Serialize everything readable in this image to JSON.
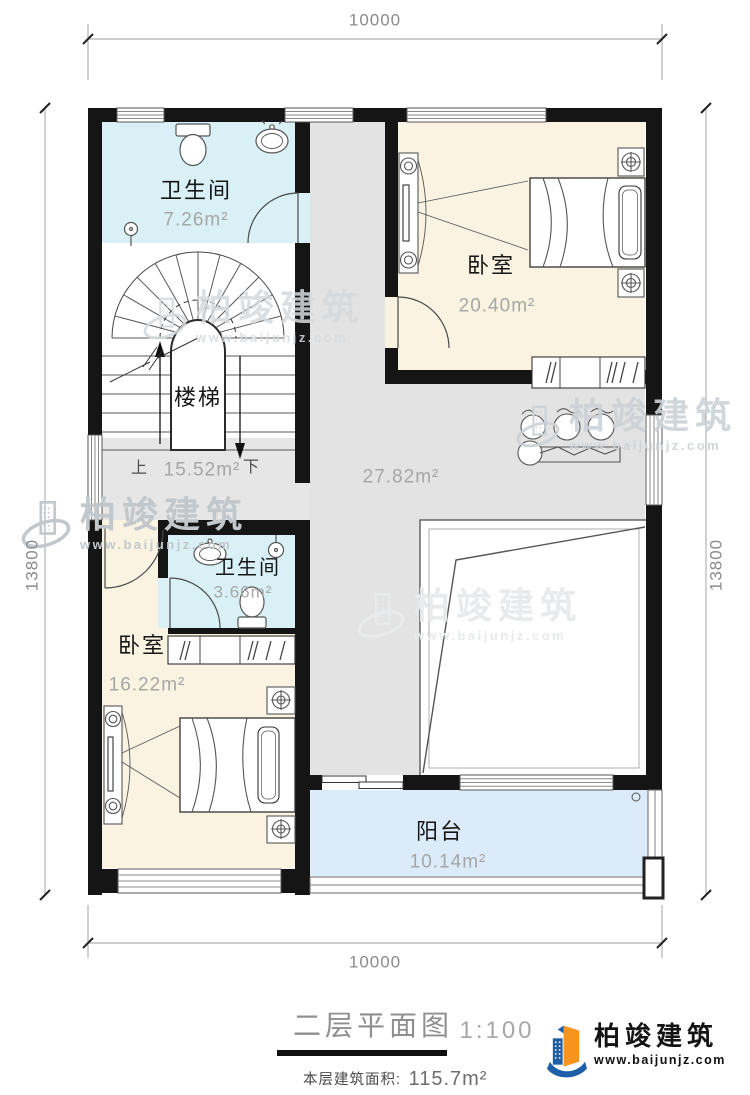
{
  "dimensions": {
    "top": "10000",
    "bottom": "10000",
    "left": "13800",
    "right": "13800"
  },
  "rooms": {
    "bath1": {
      "name": "卫生间",
      "area": "7.26m²"
    },
    "bed1": {
      "name": "卧室",
      "area": "20.40m²"
    },
    "stairs": {
      "name": "楼梯",
      "area": "15.52m²",
      "up": "上",
      "down": "下"
    },
    "hall": {
      "area": "27.82m²"
    },
    "bath2": {
      "name": "卫生间",
      "area": "3.66m²"
    },
    "bed2": {
      "name": "卧室",
      "area": "16.22m²"
    },
    "balcony": {
      "name": "阳台",
      "area": "10.14m²"
    }
  },
  "title_block": {
    "title": "二层平面图",
    "scale": "1:100",
    "area_label": "本层建筑面积:",
    "area_value": "115.7m²"
  },
  "logo": {
    "brand": "柏竣建筑",
    "site": "www.baijunjz.com"
  },
  "watermark": {
    "brand": "柏竣建筑",
    "site": "www.baijunjz.com"
  },
  "colors": {
    "wall": "#151515",
    "bathroom_fill": "#d9f1f6",
    "bedroom_fill": "#faf3e2",
    "hall_fill": "#e3e3e3",
    "balcony_fill": "#dcebf9",
    "logo_blue": "#1e5fa8",
    "logo_orange": "#f7941d"
  }
}
